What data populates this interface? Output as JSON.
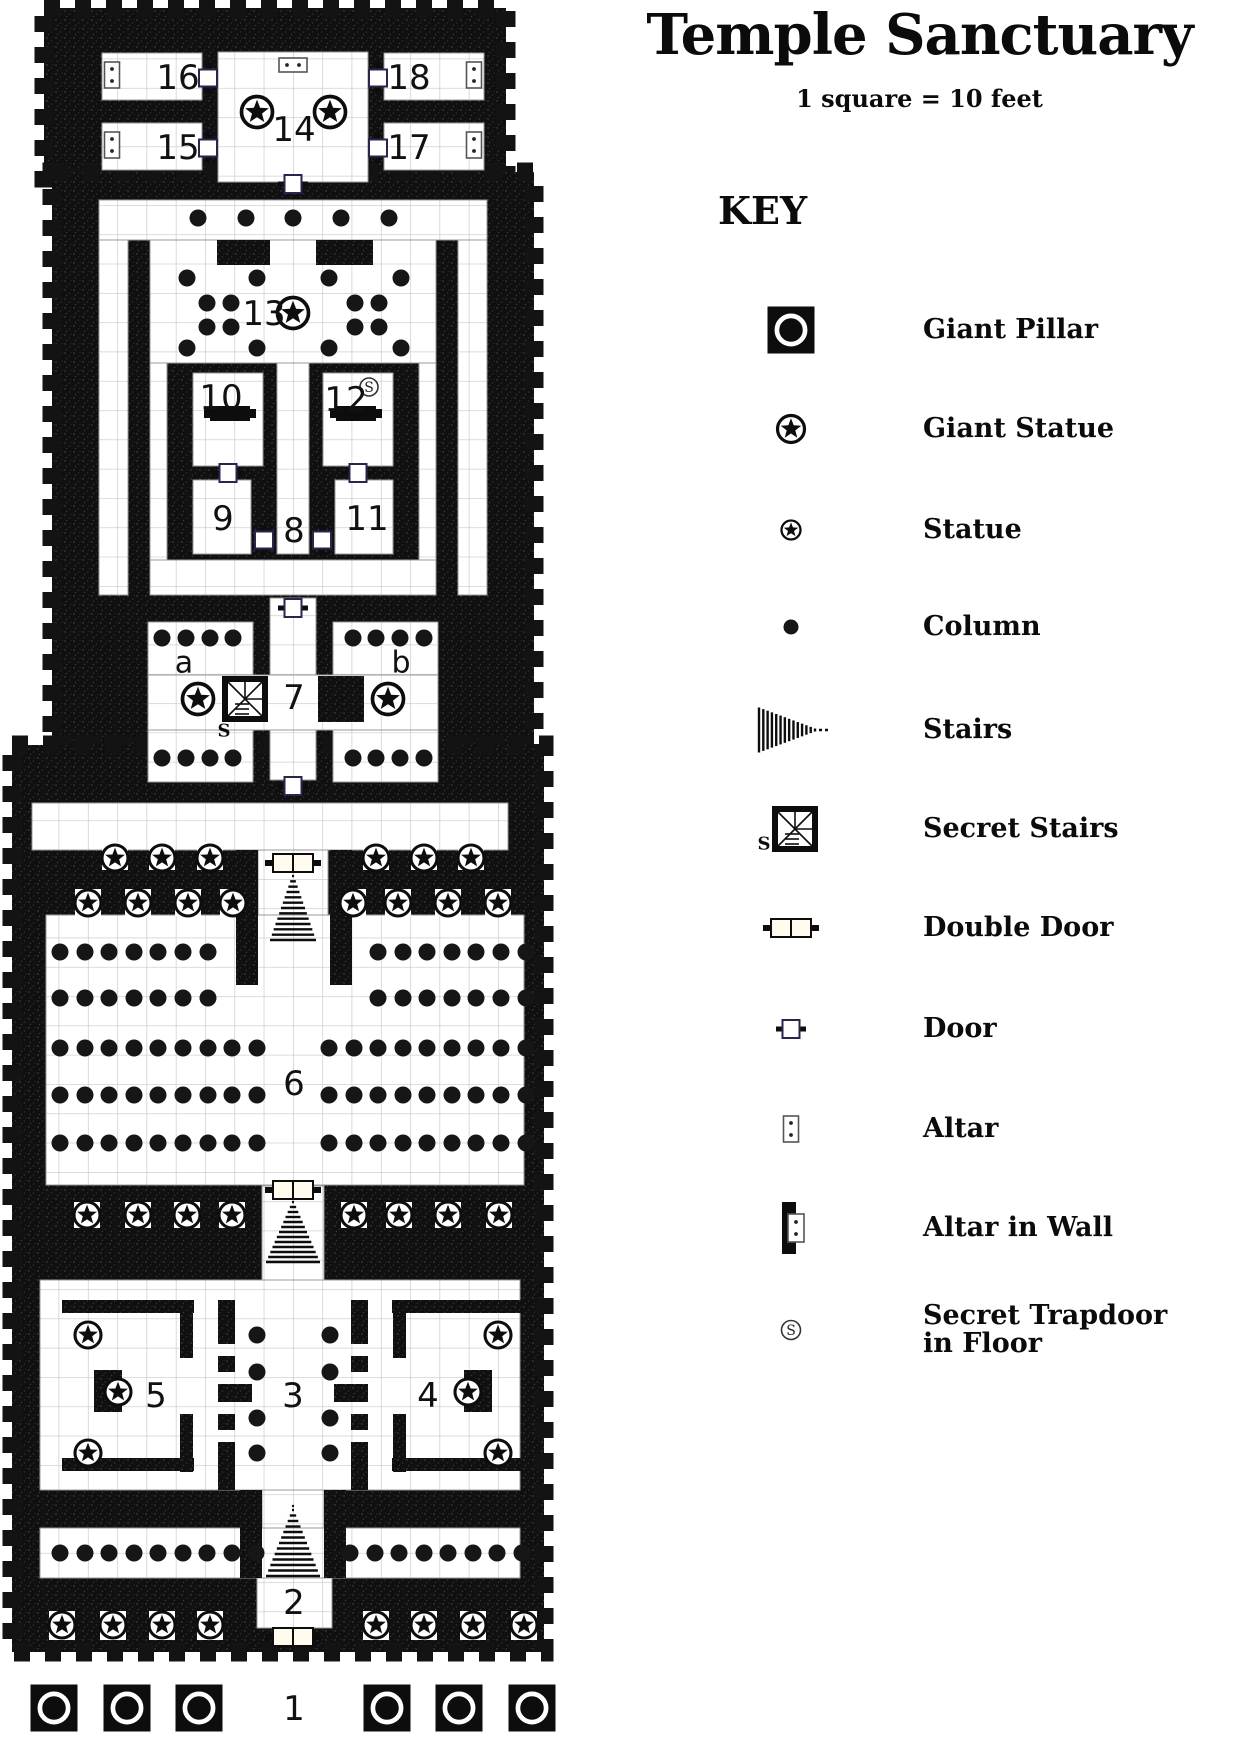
{
  "title": "Temple Sanctuary",
  "scale_note": "1 square = 10 feet",
  "key": {
    "heading": "KEY",
    "icon_x": 791,
    "label_x": 923,
    "items": [
      {
        "icon": "giant-pillar-icon",
        "label": "Giant Pillar",
        "y": 330
      },
      {
        "icon": "giant-statue-icon",
        "label": "Giant Statue",
        "y": 429
      },
      {
        "icon": "statue-icon",
        "label": "Statue",
        "y": 530
      },
      {
        "icon": "column-icon",
        "label": "Column",
        "y": 627
      },
      {
        "icon": "stairs-icon",
        "label": "Stairs",
        "y": 730
      },
      {
        "icon": "secret-stairs-icon",
        "label": "Secret Stairs",
        "y": 829
      },
      {
        "icon": "double-door-icon",
        "label": "Double Door",
        "y": 928
      },
      {
        "icon": "door-icon",
        "label": "Door",
        "y": 1029
      },
      {
        "icon": "altar-icon",
        "label": "Altar",
        "y": 1129
      },
      {
        "icon": "altar-in-wall-icon",
        "label": "Altar in Wall",
        "y": 1228
      },
      {
        "icon": "secret-trapdoor-icon",
        "label": "Secret Trapdoor|in Floor",
        "y": 1330
      }
    ]
  },
  "map": {
    "grid_size": 29.3,
    "colors": {
      "wall": "#101010",
      "speck": "#3a3a3a",
      "grid": "#c7c7c7",
      "floor": "#ffffff",
      "ink": "#0d0d0d"
    },
    "silhouettes": [
      [
        44,
        8,
        462,
        170
      ],
      [
        52,
        172,
        482,
        573
      ],
      [
        12,
        745,
        532,
        907
      ]
    ],
    "floors": [
      [
        102,
        53,
        100,
        47
      ],
      [
        102,
        123,
        100,
        47
      ],
      [
        384,
        53,
        100,
        47
      ],
      [
        384,
        123,
        100,
        47
      ],
      [
        218,
        52,
        150,
        130
      ],
      [
        99,
        200,
        388,
        40
      ],
      [
        99,
        240,
        29,
        355
      ],
      [
        458,
        240,
        29,
        355
      ],
      [
        150,
        240,
        286,
        123
      ],
      [
        150,
        363,
        17,
        197
      ],
      [
        419,
        363,
        17,
        197
      ],
      [
        193,
        373,
        70,
        93
      ],
      [
        323,
        373,
        70,
        93
      ],
      [
        277,
        363,
        32,
        191
      ],
      [
        193,
        480,
        58,
        74
      ],
      [
        335,
        480,
        58,
        74
      ],
      [
        150,
        560,
        286,
        35
      ],
      [
        270,
        598,
        46,
        77
      ],
      [
        148,
        622,
        105,
        53
      ],
      [
        333,
        622,
        105,
        53
      ],
      [
        148,
        675,
        290,
        55
      ],
      [
        148,
        730,
        105,
        52
      ],
      [
        333,
        730,
        105,
        52
      ],
      [
        270,
        730,
        46,
        50
      ],
      [
        32,
        803,
        476,
        47
      ],
      [
        258,
        850,
        70,
        132
      ],
      [
        46,
        915,
        478,
        270
      ],
      [
        262,
        1186,
        62,
        94
      ],
      [
        40,
        1280,
        480,
        210
      ],
      [
        262,
        1490,
        62,
        88
      ],
      [
        40,
        1528,
        480,
        50
      ],
      [
        257,
        1578,
        75,
        50
      ]
    ],
    "niches": [
      [
        102,
        842,
        26,
        28
      ],
      [
        149,
        842,
        26,
        28
      ],
      [
        197,
        842,
        26,
        28
      ],
      [
        363,
        842,
        26,
        28
      ],
      [
        411,
        842,
        26,
        28
      ],
      [
        458,
        842,
        26,
        28
      ],
      [
        75,
        889,
        26,
        27
      ],
      [
        125,
        889,
        26,
        27
      ],
      [
        175,
        889,
        26,
        27
      ],
      [
        220,
        889,
        26,
        27
      ],
      [
        340,
        889,
        26,
        27
      ],
      [
        385,
        889,
        26,
        27
      ],
      [
        435,
        889,
        26,
        27
      ],
      [
        485,
        889,
        26,
        27
      ],
      [
        74,
        1202,
        26,
        26
      ],
      [
        125,
        1202,
        26,
        26
      ],
      [
        174,
        1202,
        26,
        26
      ],
      [
        219,
        1202,
        26,
        26
      ],
      [
        341,
        1202,
        26,
        26
      ],
      [
        386,
        1202,
        26,
        26
      ],
      [
        435,
        1202,
        26,
        26
      ],
      [
        486,
        1202,
        26,
        26
      ],
      [
        49,
        1611,
        26,
        29
      ],
      [
        100,
        1611,
        26,
        29
      ],
      [
        149,
        1611,
        26,
        29
      ],
      [
        197,
        1611,
        26,
        29
      ],
      [
        363,
        1611,
        26,
        29
      ],
      [
        411,
        1611,
        26,
        29
      ],
      [
        460,
        1611,
        26,
        29
      ],
      [
        511,
        1611,
        26,
        29
      ]
    ],
    "walls": [
      [
        217,
        240,
        53,
        25
      ],
      [
        316,
        240,
        57,
        25
      ],
      [
        318,
        676,
        46,
        46
      ],
      [
        236,
        850,
        22,
        135
      ],
      [
        330,
        850,
        22,
        135
      ],
      [
        62,
        1300,
        132,
        13
      ],
      [
        62,
        1458,
        132,
        13
      ],
      [
        180,
        1300,
        13,
        58
      ],
      [
        180,
        1414,
        13,
        58
      ],
      [
        94,
        1370,
        28,
        42
      ],
      [
        392,
        1300,
        132,
        13
      ],
      [
        392,
        1458,
        132,
        13
      ],
      [
        393,
        1300,
        13,
        58
      ],
      [
        393,
        1414,
        13,
        58
      ],
      [
        464,
        1370,
        28,
        42
      ],
      [
        218,
        1300,
        17,
        44
      ],
      [
        218,
        1356,
        17,
        16
      ],
      [
        218,
        1384,
        34,
        18
      ],
      [
        218,
        1414,
        17,
        16
      ],
      [
        218,
        1442,
        17,
        48
      ],
      [
        351,
        1300,
        17,
        44
      ],
      [
        351,
        1356,
        17,
        16
      ],
      [
        334,
        1384,
        34,
        18
      ],
      [
        351,
        1414,
        17,
        16
      ],
      [
        351,
        1442,
        17,
        48
      ],
      [
        240,
        1490,
        22,
        88
      ],
      [
        324,
        1490,
        22,
        88
      ]
    ],
    "altar_blocks": [
      [
        210,
        406,
        40,
        15
      ],
      [
        204,
        409,
        6,
        9
      ],
      [
        250,
        409,
        6,
        9
      ],
      [
        336,
        406,
        40,
        15
      ],
      [
        330,
        409,
        6,
        9
      ],
      [
        376,
        409,
        6,
        9
      ]
    ],
    "columns": {
      "r": 8.5,
      "rows": [
        {
          "y": 218,
          "x": [
            198,
            246,
            293,
            341,
            389
          ]
        },
        {
          "y": 278,
          "x": [
            187,
            257,
            329,
            401
          ]
        },
        {
          "y": 348,
          "x": [
            187,
            257,
            329,
            401
          ]
        },
        {
          "y": 303,
          "x": [
            207,
            231,
            355,
            379
          ]
        },
        {
          "y": 327,
          "x": [
            207,
            231,
            355,
            379
          ]
        },
        {
          "y": 638,
          "x": [
            162,
            186,
            210,
            233,
            353,
            376,
            400,
            424
          ]
        },
        {
          "y": 758,
          "x": [
            162,
            186,
            210,
            233,
            353,
            376,
            400,
            424
          ]
        },
        {
          "y": 952,
          "x": [
            60,
            85,
            109,
            134,
            158,
            183,
            208,
            378,
            403,
            427,
            452,
            476,
            501,
            526
          ]
        },
        {
          "y": 998,
          "x": [
            60,
            85,
            109,
            134,
            158,
            183,
            208,
            378,
            403,
            427,
            452,
            476,
            501,
            526
          ]
        },
        {
          "y": 1048,
          "x": [
            60,
            85,
            109,
            134,
            158,
            183,
            208,
            232,
            257,
            329,
            354,
            378,
            403,
            427,
            452,
            476,
            501,
            526
          ]
        },
        {
          "y": 1095,
          "x": [
            60,
            85,
            109,
            134,
            158,
            183,
            208,
            232,
            257,
            329,
            354,
            378,
            403,
            427,
            452,
            476,
            501,
            526
          ]
        },
        {
          "y": 1143,
          "x": [
            60,
            85,
            109,
            134,
            158,
            183,
            208,
            232,
            257,
            329,
            354,
            378,
            403,
            427,
            452,
            476,
            501,
            526
          ]
        },
        {
          "y": 1335,
          "x": [
            257,
            330
          ]
        },
        {
          "y": 1372,
          "x": [
            257,
            330
          ]
        },
        {
          "y": 1418,
          "x": [
            257,
            330
          ]
        },
        {
          "y": 1453,
          "x": [
            257,
            330
          ]
        },
        {
          "y": 1553,
          "x": [
            60,
            85,
            109,
            134,
            158,
            183,
            207,
            232,
            256,
            350,
            375,
            399,
            424,
            448,
            473,
            497,
            522
          ]
        }
      ]
    },
    "statues": {
      "r": 13,
      "rows": [
        {
          "y": 858,
          "x": [
            115,
            162,
            210,
            376,
            424,
            471
          ]
        },
        {
          "y": 903,
          "x": [
            88,
            138,
            188,
            233,
            353,
            398,
            448,
            498
          ]
        },
        {
          "y": 1215,
          "x": [
            87,
            138,
            187,
            232,
            354,
            399,
            448,
            499
          ]
        },
        {
          "y": 1625,
          "x": [
            62,
            113,
            162,
            210,
            376,
            424,
            473,
            524
          ]
        },
        {
          "y": 1335,
          "x": [
            88,
            498
          ]
        },
        {
          "y": 1392,
          "x": [
            118,
            468
          ]
        },
        {
          "y": 1453,
          "x": [
            88,
            498
          ]
        }
      ]
    },
    "giant_statues": {
      "r": 15.5,
      "pts": [
        [
          257,
          112
        ],
        [
          330,
          112
        ],
        [
          293,
          313
        ],
        [
          198,
          699
        ],
        [
          388,
          699
        ]
      ]
    },
    "giant_pillars": {
      "size": 47,
      "pts": [
        [
          54,
          1708
        ],
        [
          127,
          1708
        ],
        [
          199,
          1708
        ],
        [
          387,
          1708
        ],
        [
          459,
          1708
        ],
        [
          532,
          1708
        ]
      ]
    },
    "doors": [
      {
        "x": 208,
        "y": 78,
        "o": "v"
      },
      {
        "x": 208,
        "y": 148,
        "o": "v"
      },
      {
        "x": 378,
        "y": 78,
        "o": "v"
      },
      {
        "x": 378,
        "y": 148,
        "o": "v"
      },
      {
        "x": 293,
        "y": 184,
        "o": "h"
      },
      {
        "x": 228,
        "y": 473,
        "o": "h"
      },
      {
        "x": 358,
        "y": 473,
        "o": "h"
      },
      {
        "x": 264,
        "y": 540,
        "o": "v"
      },
      {
        "x": 322,
        "y": 540,
        "o": "v"
      },
      {
        "x": 293,
        "y": 608,
        "o": "h"
      },
      {
        "x": 293,
        "y": 786,
        "o": "h"
      }
    ],
    "double_doors": [
      [
        293,
        863
      ],
      [
        293,
        1190
      ],
      [
        293,
        1637
      ]
    ],
    "altars_v": [
      [
        112,
        75
      ],
      [
        112,
        145
      ],
      [
        474,
        75
      ],
      [
        474,
        145
      ]
    ],
    "altars_h": [
      [
        293,
        65
      ]
    ],
    "stairs": [
      {
        "x": 293,
        "y0": 876,
        "y1": 940,
        "w": 46
      },
      {
        "x": 293,
        "y0": 1202,
        "y1": 1262,
        "w": 54
      },
      {
        "x": 293,
        "y0": 1510,
        "y1": 1576,
        "w": 54
      }
    ],
    "secret_stairs": [
      {
        "x": 245,
        "y": 699,
        "s": 46
      }
    ],
    "trapdoors": [
      [
        369,
        387
      ]
    ],
    "labels": [
      {
        "t": "16",
        "x": 178,
        "y": 78
      },
      {
        "t": "15",
        "x": 178,
        "y": 148
      },
      {
        "t": "18",
        "x": 409,
        "y": 78
      },
      {
        "t": "17",
        "x": 409,
        "y": 148
      },
      {
        "t": "14",
        "x": 294,
        "y": 130
      },
      {
        "t": "13",
        "x": 264,
        "y": 314
      },
      {
        "t": "10",
        "x": 221,
        "y": 398
      },
      {
        "t": "12",
        "x": 346,
        "y": 400
      },
      {
        "t": "9",
        "x": 223,
        "y": 519
      },
      {
        "t": "8",
        "x": 294,
        "y": 531
      },
      {
        "t": "11",
        "x": 367,
        "y": 519
      },
      {
        "t": "7",
        "x": 294,
        "y": 698
      },
      {
        "t": "a",
        "x": 184,
        "y": 663,
        "s": 30
      },
      {
        "t": "b",
        "x": 401,
        "y": 663,
        "s": 30
      },
      {
        "t": "6",
        "x": 294,
        "y": 1084
      },
      {
        "t": "5",
        "x": 156,
        "y": 1396
      },
      {
        "t": "3",
        "x": 293,
        "y": 1396
      },
      {
        "t": "4",
        "x": 428,
        "y": 1396
      },
      {
        "t": "2",
        "x": 294,
        "y": 1603
      },
      {
        "t": "1",
        "x": 294,
        "y": 1709
      }
    ]
  }
}
